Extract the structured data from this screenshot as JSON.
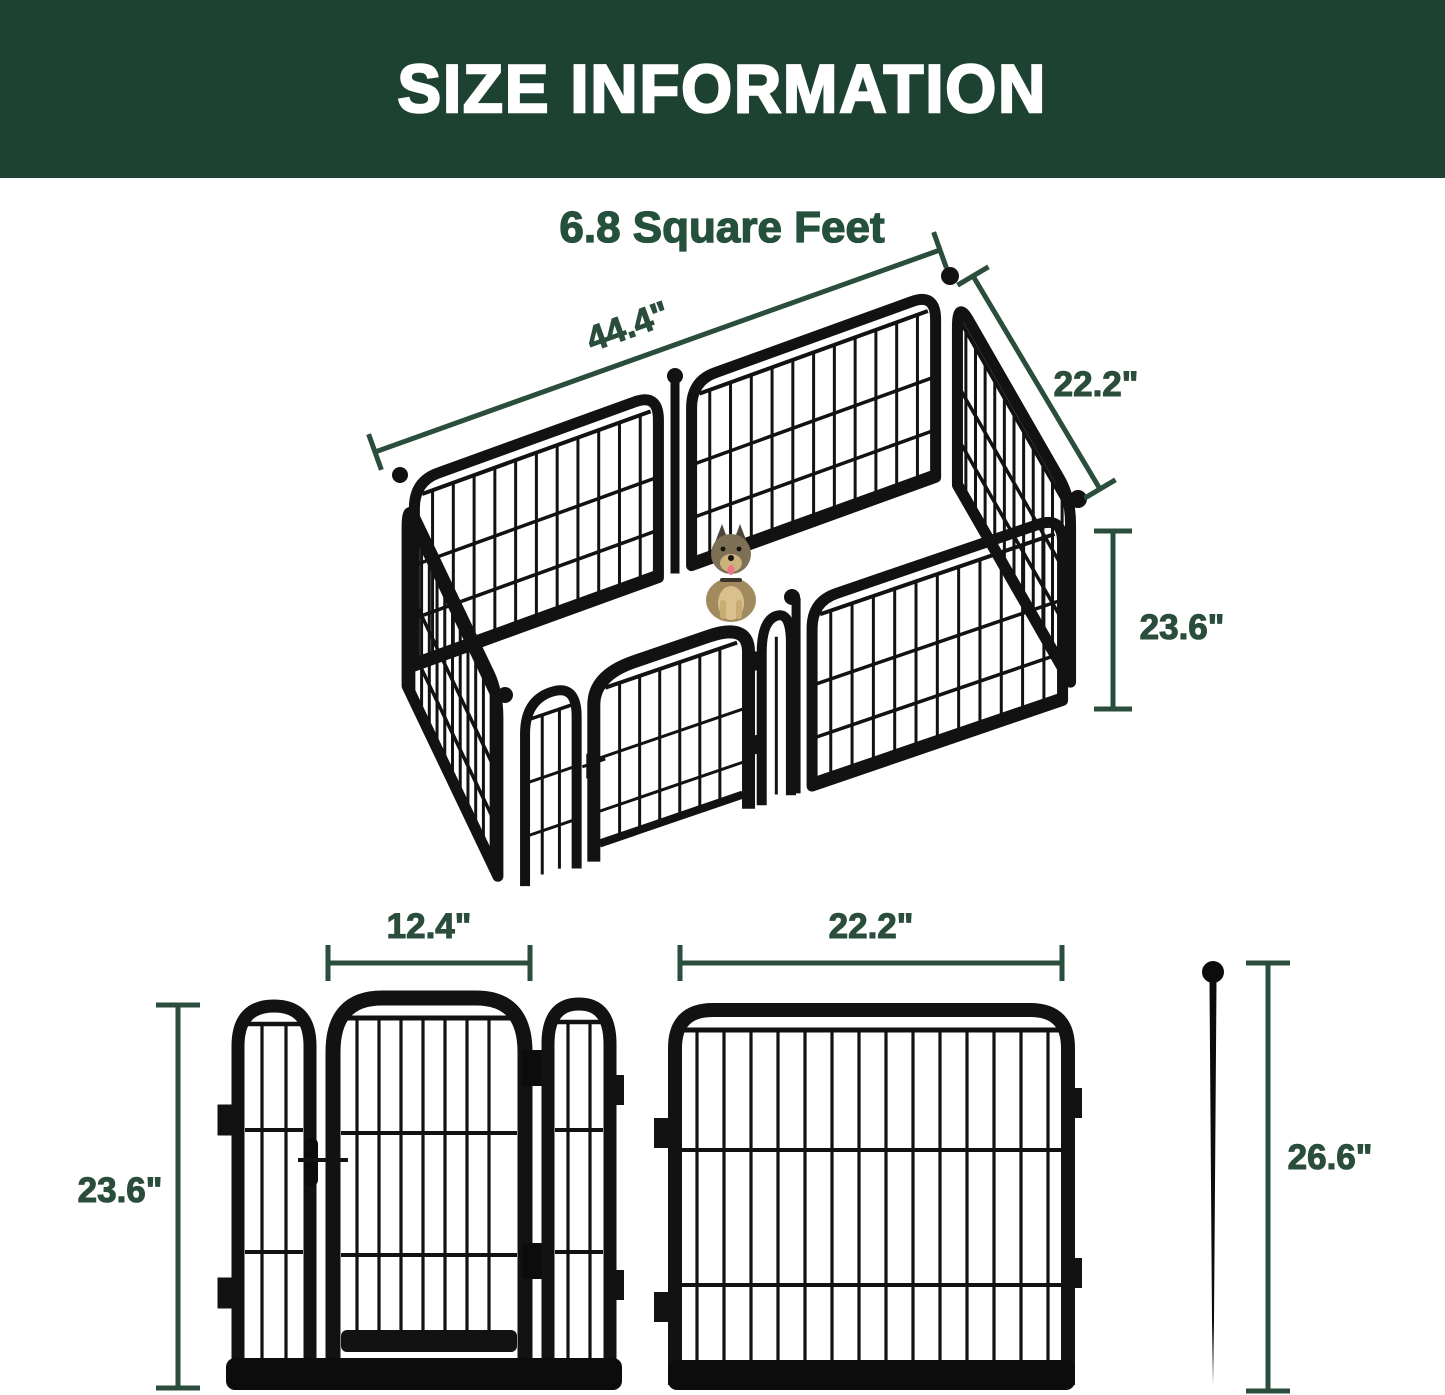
{
  "header": {
    "title": "SIZE INFORMATION"
  },
  "subtitle": "6.8 Square Feet",
  "colors": {
    "header_bg": "#1d4232",
    "accent_green": "#2a4d3c",
    "fence_black": "#121212"
  },
  "pen_3d": {
    "width_label": "44.4\"",
    "depth_label": "22.2\"",
    "height_label": "23.6\""
  },
  "gate_panel": {
    "door_width_label": "12.4\"",
    "height_label": "23.6\""
  },
  "regular_panel": {
    "width_label": "22.2\""
  },
  "stake": {
    "height_label": "26.6\""
  }
}
